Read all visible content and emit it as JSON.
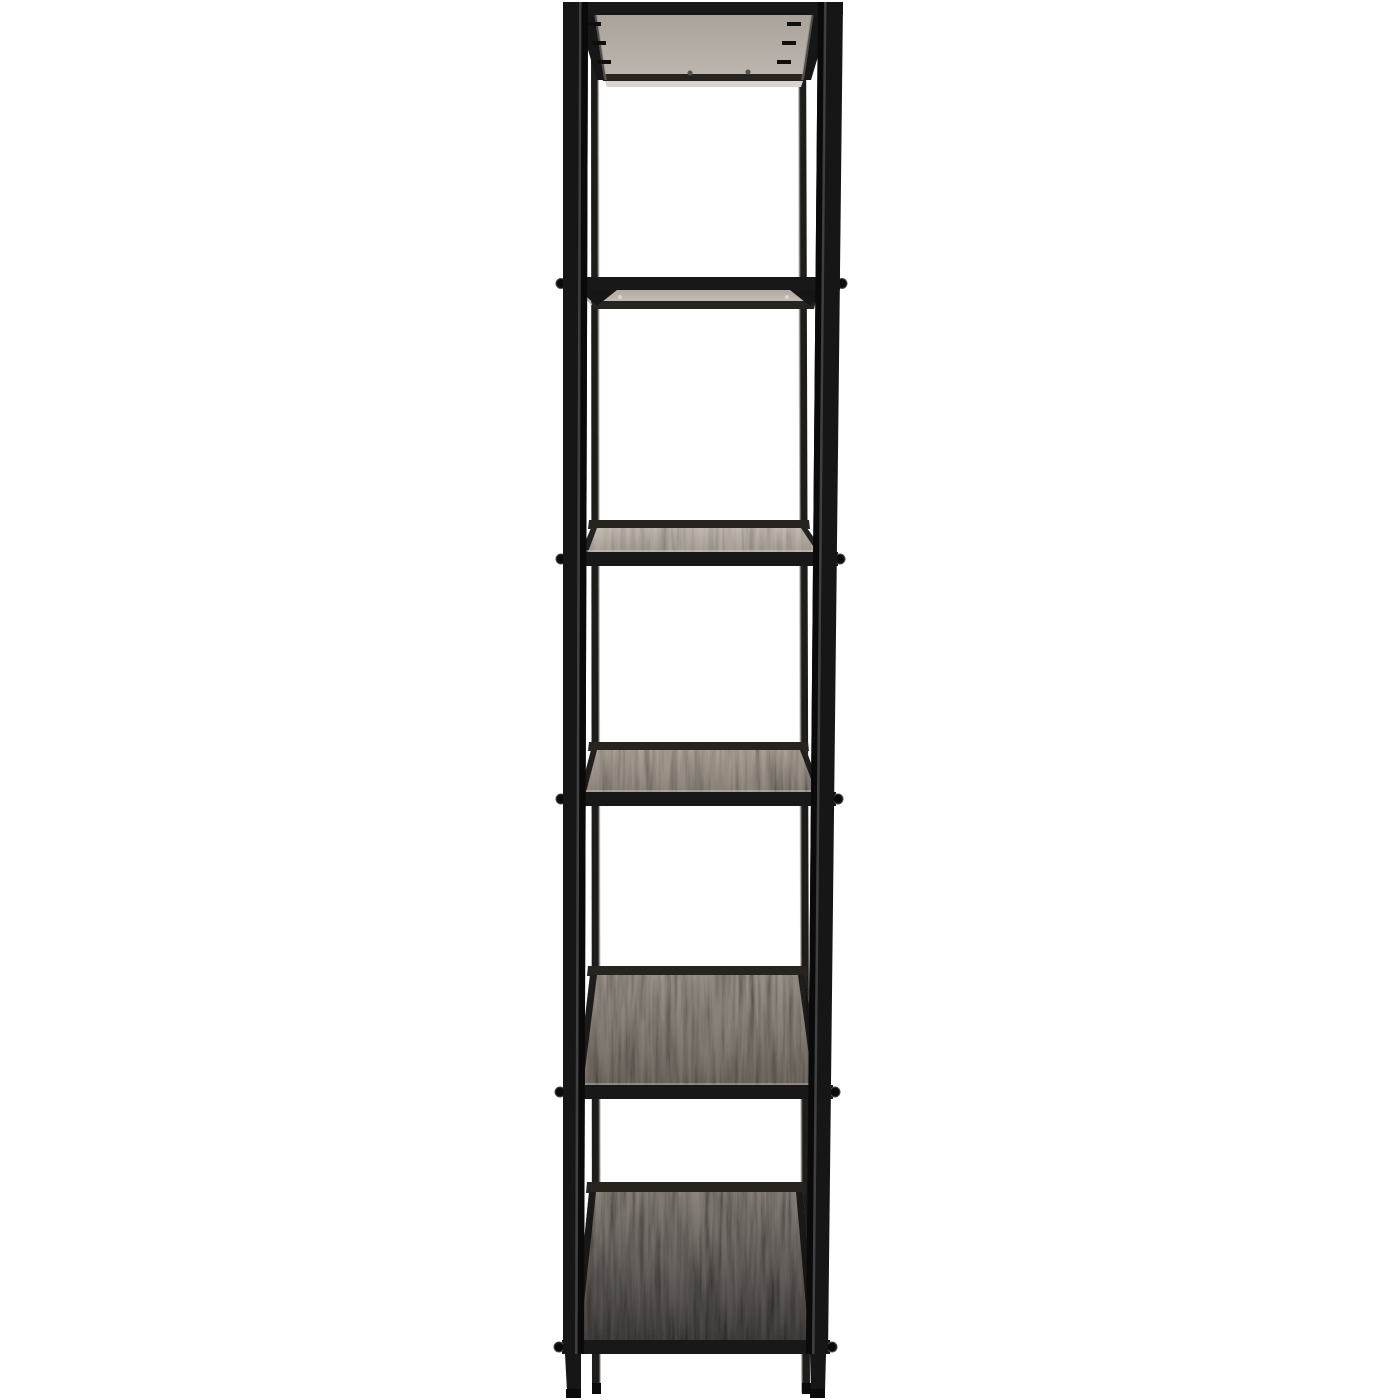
{
  "meta": {
    "description": "Studio product photo of a tall, narrow industrial-style shelving unit with a black metal frame, a metal-backed top panel and five dark wood-grain shelves, photographed front-on against a plain white background. Upper levels show their light metal undersides; lower levels show progressively more of their wood tops.",
    "background": "#ffffff"
  },
  "product": {
    "kind": "open shelving unit / etagere",
    "frame_material": "black steel, square tube",
    "shelf_material": "black-brown wood with visible grain",
    "levels": 6,
    "wood_shelves": 5,
    "legs": 4,
    "hardware": "round screw heads at every crossbar end, three mounting clips per side under the top panel"
  },
  "colors": {
    "bg": "#ffffff",
    "frame": "#181818",
    "frame_face": "#161616",
    "frame_side": "#0a0a0a",
    "frame_hl": "#585858",
    "back_post": "#1e1d1b",
    "back_rail": "#27241f",
    "gap_light": "#d9d4cc",
    "edge_light": "#8a867f",
    "screw": "#0b0b0b",
    "screw_ring": "#4a4a4a",
    "clip": "#0e0e0e",
    "panel_screw": "#55504a",
    "l1a": "#a9a29a",
    "l1b": "#bdb7af",
    "l2a": "#b2aba3",
    "l2b": "#c8c1b9",
    "s3a": "#c3bbb0",
    "s3b": "#a9a197",
    "s4a": "#aca396",
    "s4b": "#8d857c",
    "s5a": "#9b938a",
    "s5b": "#736c65",
    "s6a": "#8b847d",
    "s6b": "#454140"
  }
}
